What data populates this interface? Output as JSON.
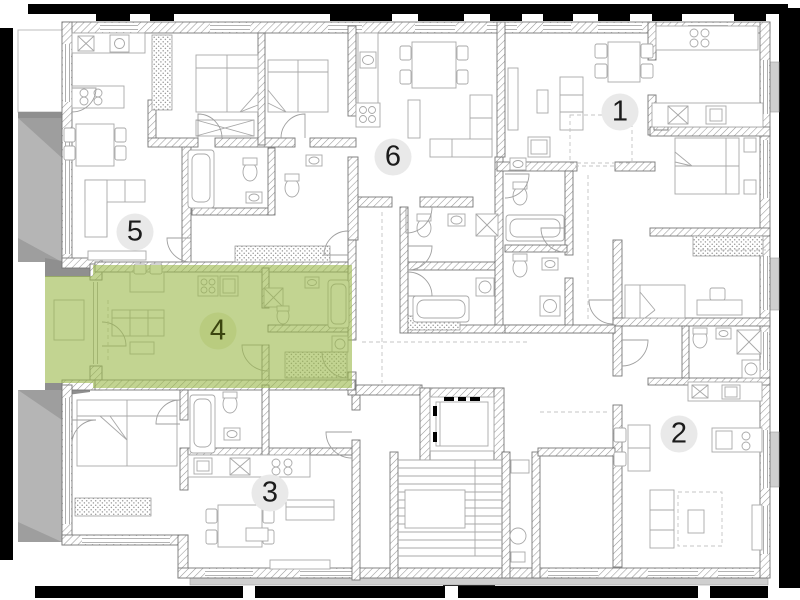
{
  "meta": {
    "view": "residential-floor-plan",
    "canvas_width": 800,
    "canvas_height": 600
  },
  "floorplan": {
    "selected_apartment": "4",
    "apartments": [
      {
        "number": "1",
        "badge_x": 620,
        "badge_y": 112,
        "selected": false
      },
      {
        "number": "2",
        "badge_x": 679,
        "badge_y": 434,
        "selected": false
      },
      {
        "number": "3",
        "badge_x": 270,
        "badge_y": 493,
        "selected": false
      },
      {
        "number": "4",
        "badge_x": 218,
        "badge_y": 331,
        "selected": true
      },
      {
        "number": "5",
        "badge_x": 135,
        "badge_y": 232,
        "selected": false
      },
      {
        "number": "6",
        "badge_x": 393,
        "badge_y": 157,
        "selected": false
      }
    ]
  },
  "colors": {
    "highlight-green": "#9cba4e",
    "badge-bg": "#e9e9e9",
    "badge-text": "#1c1c1c",
    "badge-selected-bg": "#b9cc7f",
    "badge-selected-text": "#3b450f",
    "frame-black": "#000000",
    "wall-line": "#777777",
    "furniture-line": "#a8a8a8",
    "shadow-gray": "#b5b5b5",
    "background": "#ffffff"
  }
}
